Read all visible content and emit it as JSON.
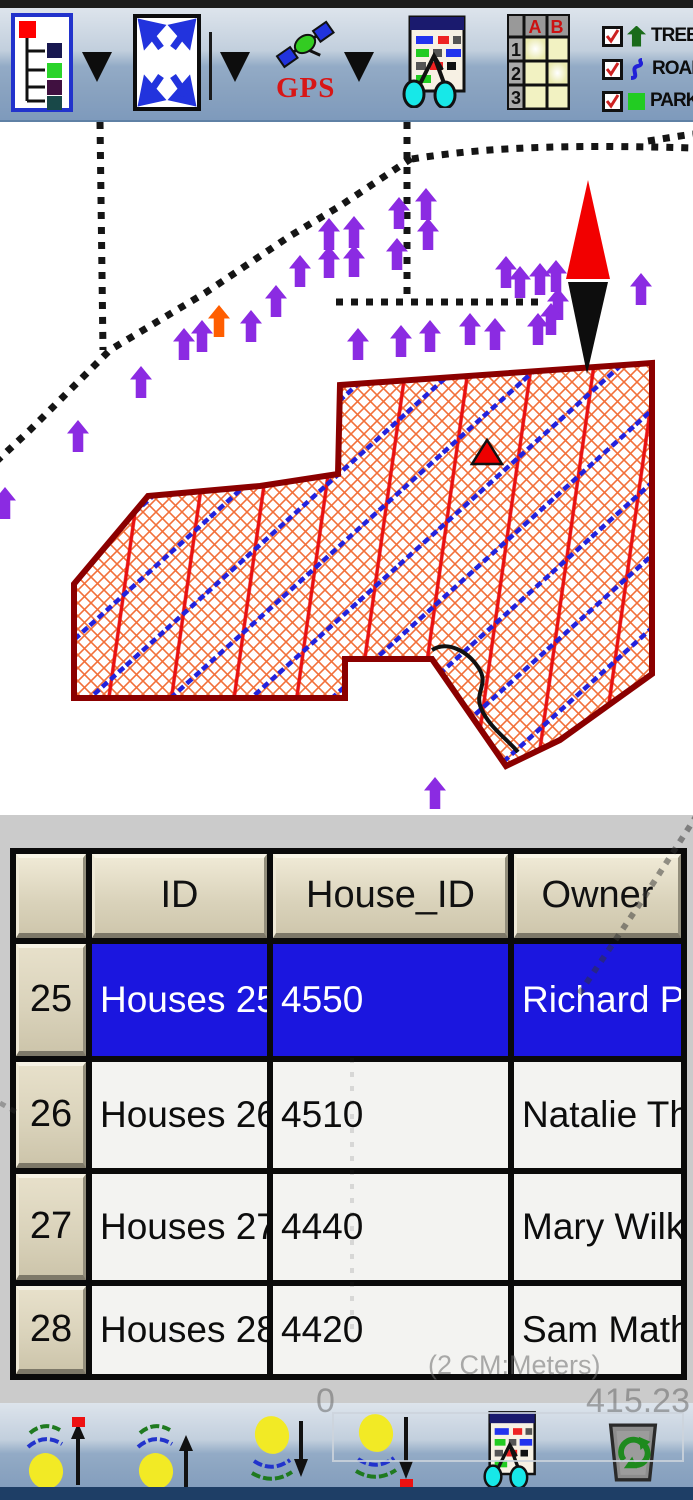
{
  "window": {
    "width": 693,
    "height": 1500
  },
  "toolbar_top": {
    "gps_label": "GPS",
    "table_icon": {
      "col_a": "A",
      "col_b": "B",
      "row_1": "1",
      "row_2": "2",
      "row_3": "3"
    },
    "legend": {
      "items": [
        {
          "label": "TREE",
          "checked": true,
          "symbol": "tree",
          "color": "#1a6b1a"
        },
        {
          "label": "ROAD",
          "checked": true,
          "symbol": "road",
          "color": "#2020d8"
        },
        {
          "label": "PARK",
          "checked": true,
          "symbol": "park",
          "color": "#22cc22"
        }
      ]
    }
  },
  "map": {
    "colors": {
      "tree_marker": "#8b2be2",
      "highlight_marker": "#ff5e00",
      "road_dots": "#151515",
      "park_border": "#8b0000",
      "park_hatch_red": "#e81212",
      "park_hatch_blue": "#2222dd",
      "park_lattice_orange": "#f2703a",
      "compass_north": "#f20000",
      "compass_south": "#0d0d0d"
    },
    "roads": [
      "M 100,0 L 103,228",
      "M -15,350 L 30,308 L 110,228 L 205,171 L 290,114 L 340,84 L 412,36",
      "M 412,37 C 480,26 560,22 693,26",
      "M 648,19 L 693,12",
      "M 407,0 L 407,180",
      "M 336,180 L 540,180"
    ],
    "park_path": "M 340,263 L 652,241 L 652,552 L 560,618 L 506,644 L 432,537 L 345,537 L 345,576 L 74,576 L 74,462 L 148,374 L 260,364 L 338,352 Z",
    "track_path": "M 432,528 C 448,518 468,530 478,545 C 490,562 474,570 481,586 C 488,604 508,618 518,630",
    "compass_north_path": "M 588,58 L 566,157 L 610,157 Z",
    "compass_south_path": "M 568,160 L 608,160 L 587,252 Z",
    "marker_triangle_path": "M 487,318 L 472,342 L 502,342 Z",
    "trees": [
      [
        399,
        91
      ],
      [
        426,
        82
      ],
      [
        428,
        112
      ],
      [
        329,
        112
      ],
      [
        354,
        110
      ],
      [
        329,
        140
      ],
      [
        354,
        139
      ],
      [
        397,
        132
      ],
      [
        300,
        149
      ],
      [
        276,
        179
      ],
      [
        251,
        204
      ],
      [
        202,
        214
      ],
      [
        184,
        222
      ],
      [
        358,
        222
      ],
      [
        401,
        219
      ],
      [
        430,
        214
      ],
      [
        470,
        207
      ],
      [
        495,
        212
      ],
      [
        506,
        150
      ],
      [
        520,
        160
      ],
      [
        540,
        157
      ],
      [
        556,
        154
      ],
      [
        558,
        182
      ],
      [
        551,
        197
      ],
      [
        538,
        207
      ],
      [
        641,
        167
      ],
      [
        141,
        260
      ],
      [
        78,
        314
      ],
      [
        435,
        671
      ],
      [
        5,
        381
      ]
    ],
    "orange_tree": [
      219,
      199
    ],
    "scale": {
      "label": "(2 CM:Meters)",
      "min": "0",
      "max": "415.23"
    }
  },
  "panel": {
    "dashes": [
      "M 697,0 L 643,84 L 577,182",
      "M 352,243 L 352,532",
      "M 0,288 L 16,297"
    ]
  },
  "table": {
    "columns": [
      "",
      "ID",
      "House_ID",
      "Owner"
    ],
    "rows": [
      {
        "num": "25",
        "id": "Houses 25",
        "house_id": "4550",
        "owner": "Richard Phe",
        "selected": true
      },
      {
        "num": "26",
        "id": "Houses 26",
        "house_id": "4510",
        "owner": "Natalie Tho",
        "selected": false
      },
      {
        "num": "27",
        "id": "Houses 27",
        "house_id": "4440",
        "owner": "Mary Wilker",
        "selected": false
      },
      {
        "num": "28",
        "id": "Houses 28",
        "house_id": "4420",
        "owner": "Sam Mathe",
        "selected": false
      }
    ],
    "selection_color": "#1b16df"
  }
}
